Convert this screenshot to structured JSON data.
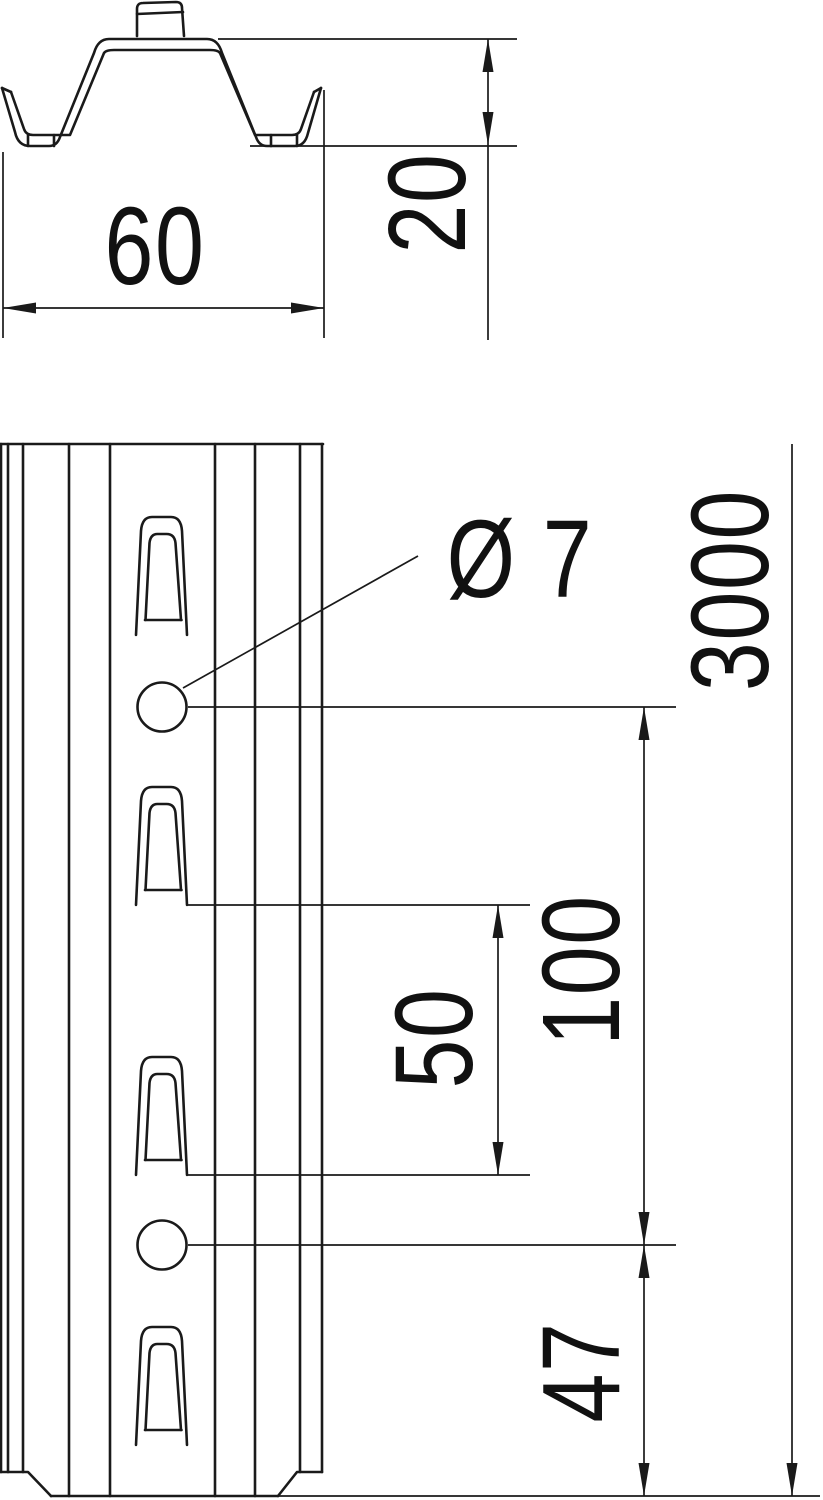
{
  "page": {
    "background_color": "#ffffff",
    "line_color": "#1a1a1a",
    "description": "Technical drawing of perforated hat-profile mounting rail with cross-section and front view"
  },
  "views": {
    "cross_section": {
      "name": "hat profile cross section",
      "dimensions": {
        "width": {
          "value": "60"
        },
        "height": {
          "value": "20"
        }
      }
    },
    "front_view": {
      "name": "perforated rail front view",
      "features": {
        "slot_count": 4,
        "hole_count": 2
      },
      "dimensions": {
        "hole_diameter": {
          "value": "Ø 7"
        },
        "total_length": {
          "value": "3000"
        },
        "hole_pitch": {
          "value": "100"
        },
        "slot_pitch": {
          "value": "50"
        },
        "end_distance": {
          "value": "47"
        }
      }
    }
  }
}
